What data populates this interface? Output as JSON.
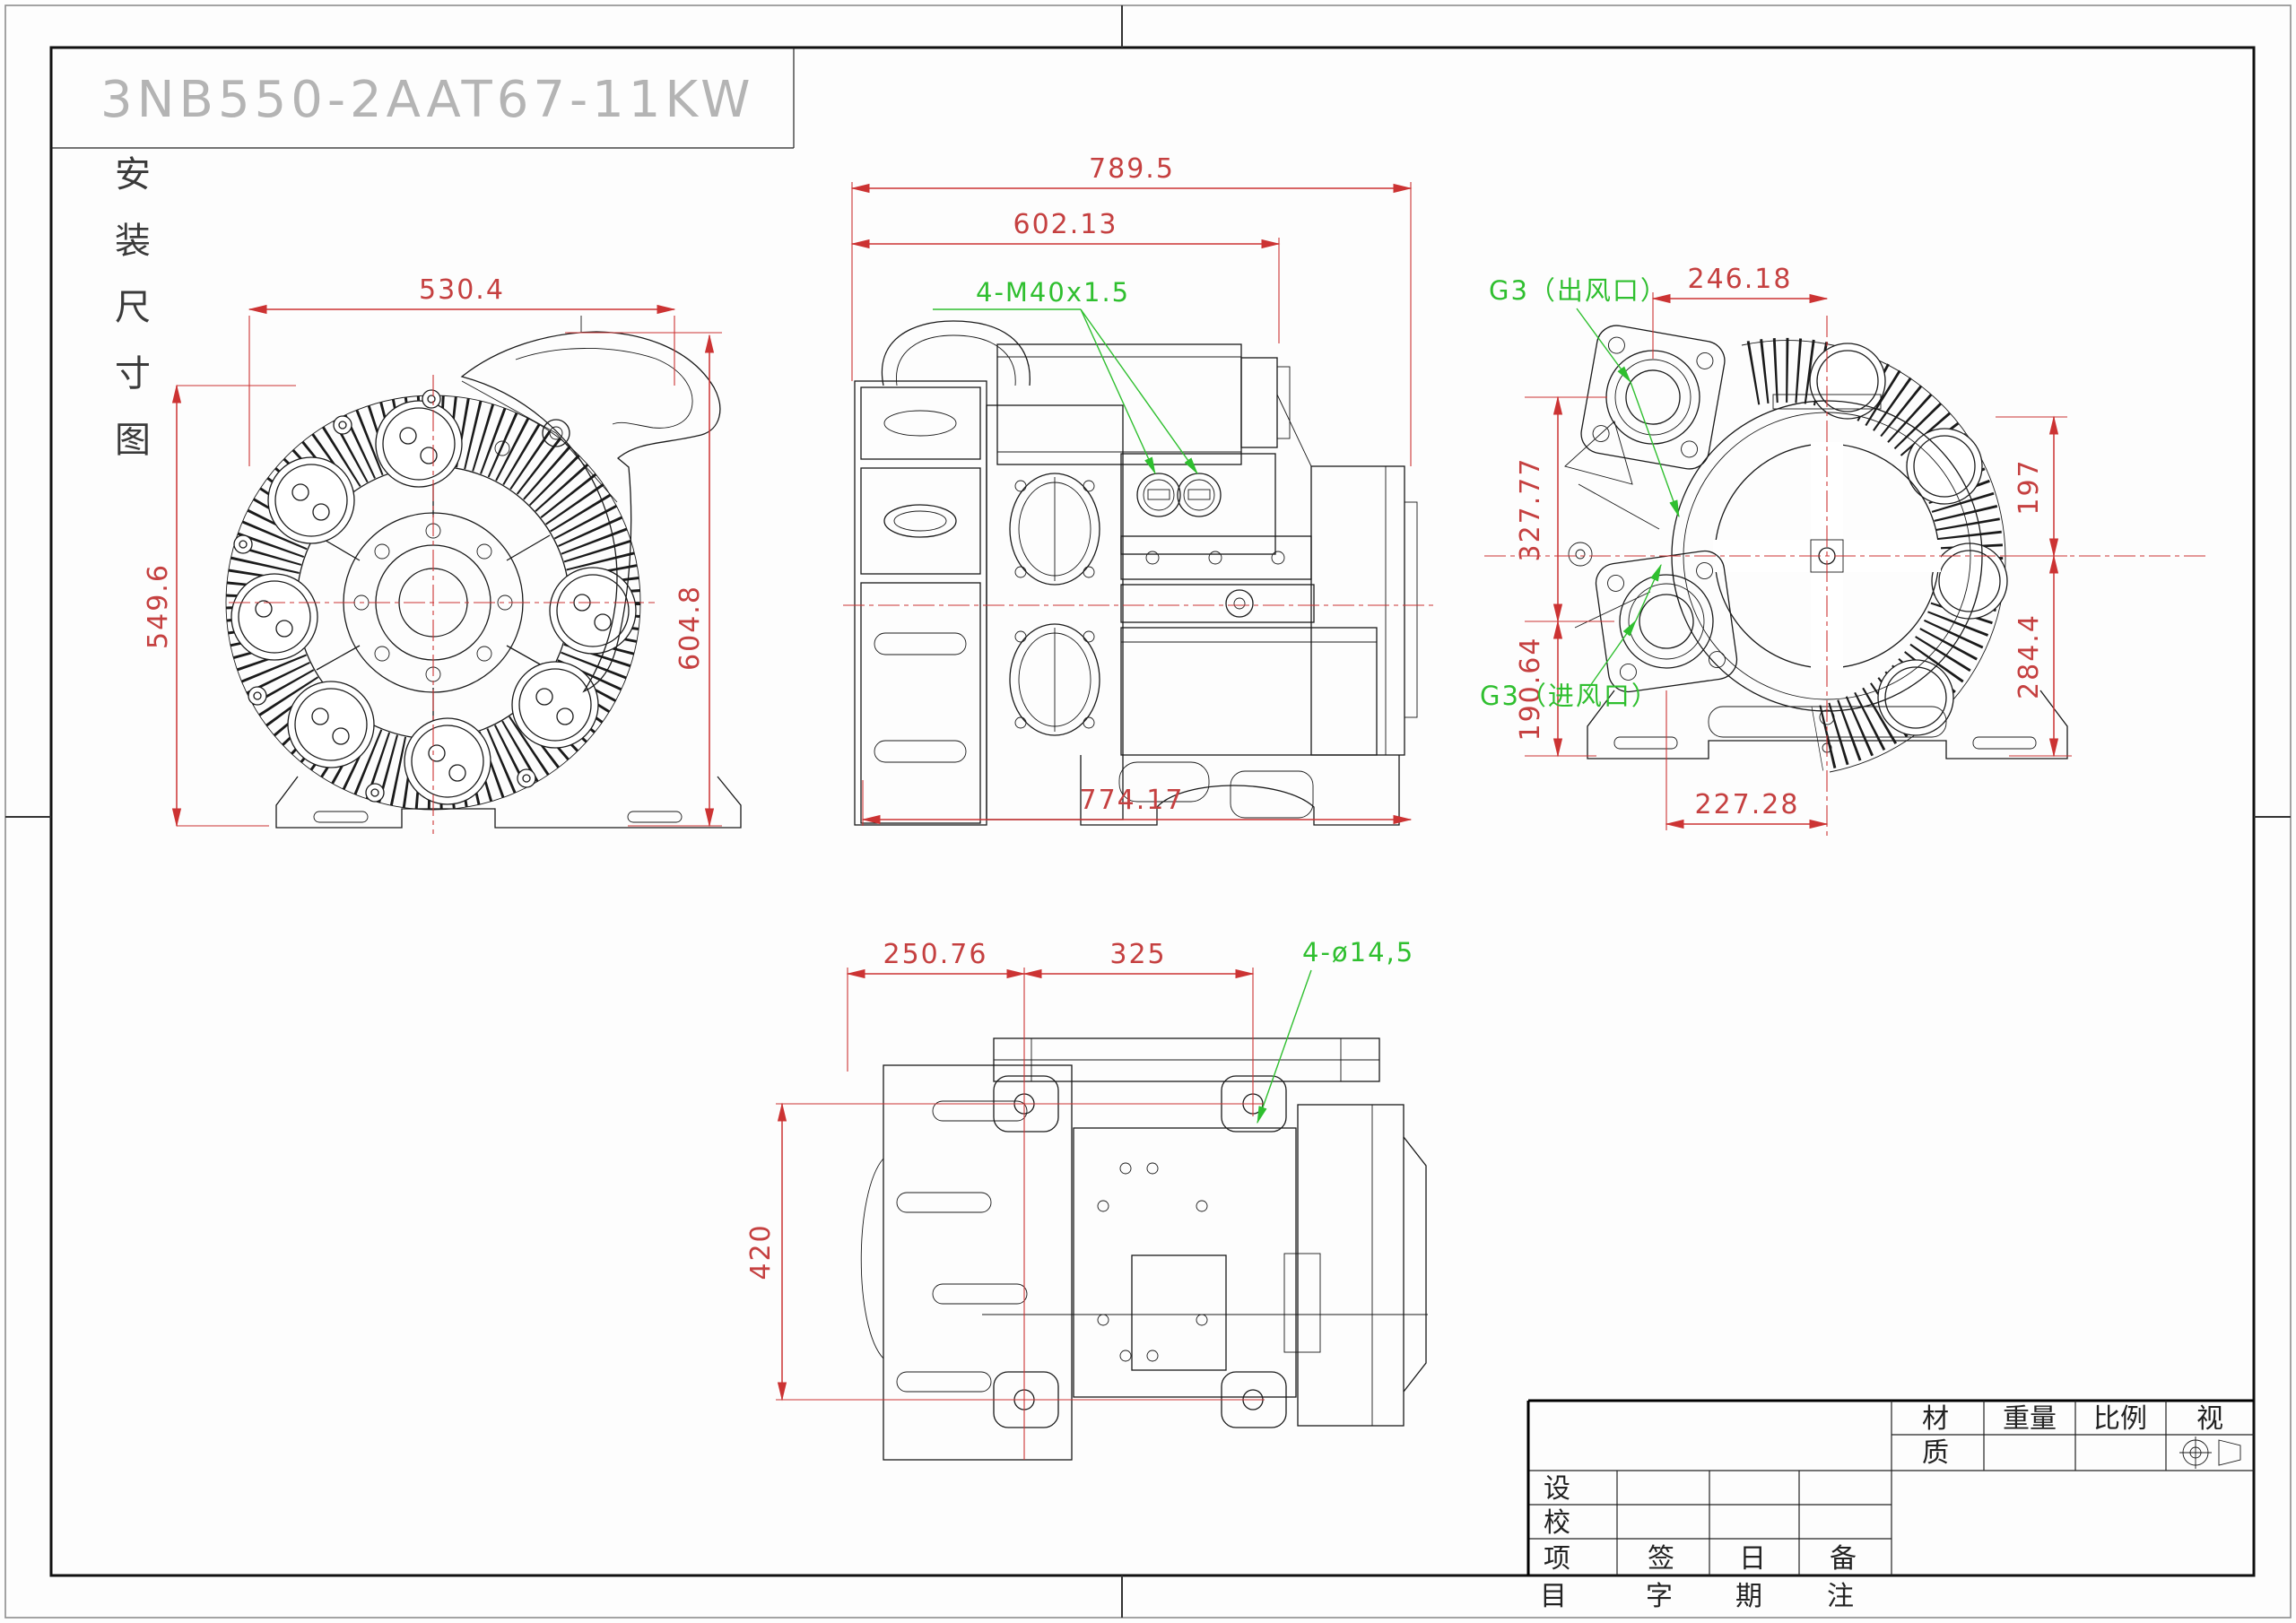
{
  "page": {
    "model": "3NB550-2AAT67-11KW",
    "side_label": "安装尺寸图",
    "side_label_chars": [
      "安",
      "装",
      "尺",
      "寸",
      "图"
    ]
  },
  "dims": {
    "front": {
      "width": "530.4",
      "height": "549.6"
    },
    "side": {
      "total": "789.5",
      "upper": "602.13",
      "height": "604.8",
      "base": "774.17"
    },
    "right": {
      "top": "246.18",
      "upper_left": "327.77",
      "lower_left": "190.64",
      "upper_right": "197",
      "lower_right": "284.4",
      "bottom": "227.28"
    },
    "bottom": {
      "left": "250.76",
      "mid": "325",
      "height": "420"
    }
  },
  "annotations": {
    "glands": "4-M40x1.5",
    "outlet": "G3（出风口）",
    "inlet": "G3（进风口）",
    "mount_holes": "4-ø14,5"
  },
  "title_block": {
    "material_top": "材",
    "material_bottom": "质",
    "weight": "重量",
    "scale": "比例",
    "view": "视",
    "rows": [
      "设",
      "校",
      "项"
    ],
    "header_row3": [
      "签",
      "日",
      "备"
    ],
    "bottom_chars": [
      "目",
      "字",
      "期",
      "注"
    ]
  },
  "colors": {
    "dimension": "#cc3333",
    "annotation": "#2fbf2f",
    "title_gray": "#b4b4b4",
    "line": "#1a1a1a"
  }
}
